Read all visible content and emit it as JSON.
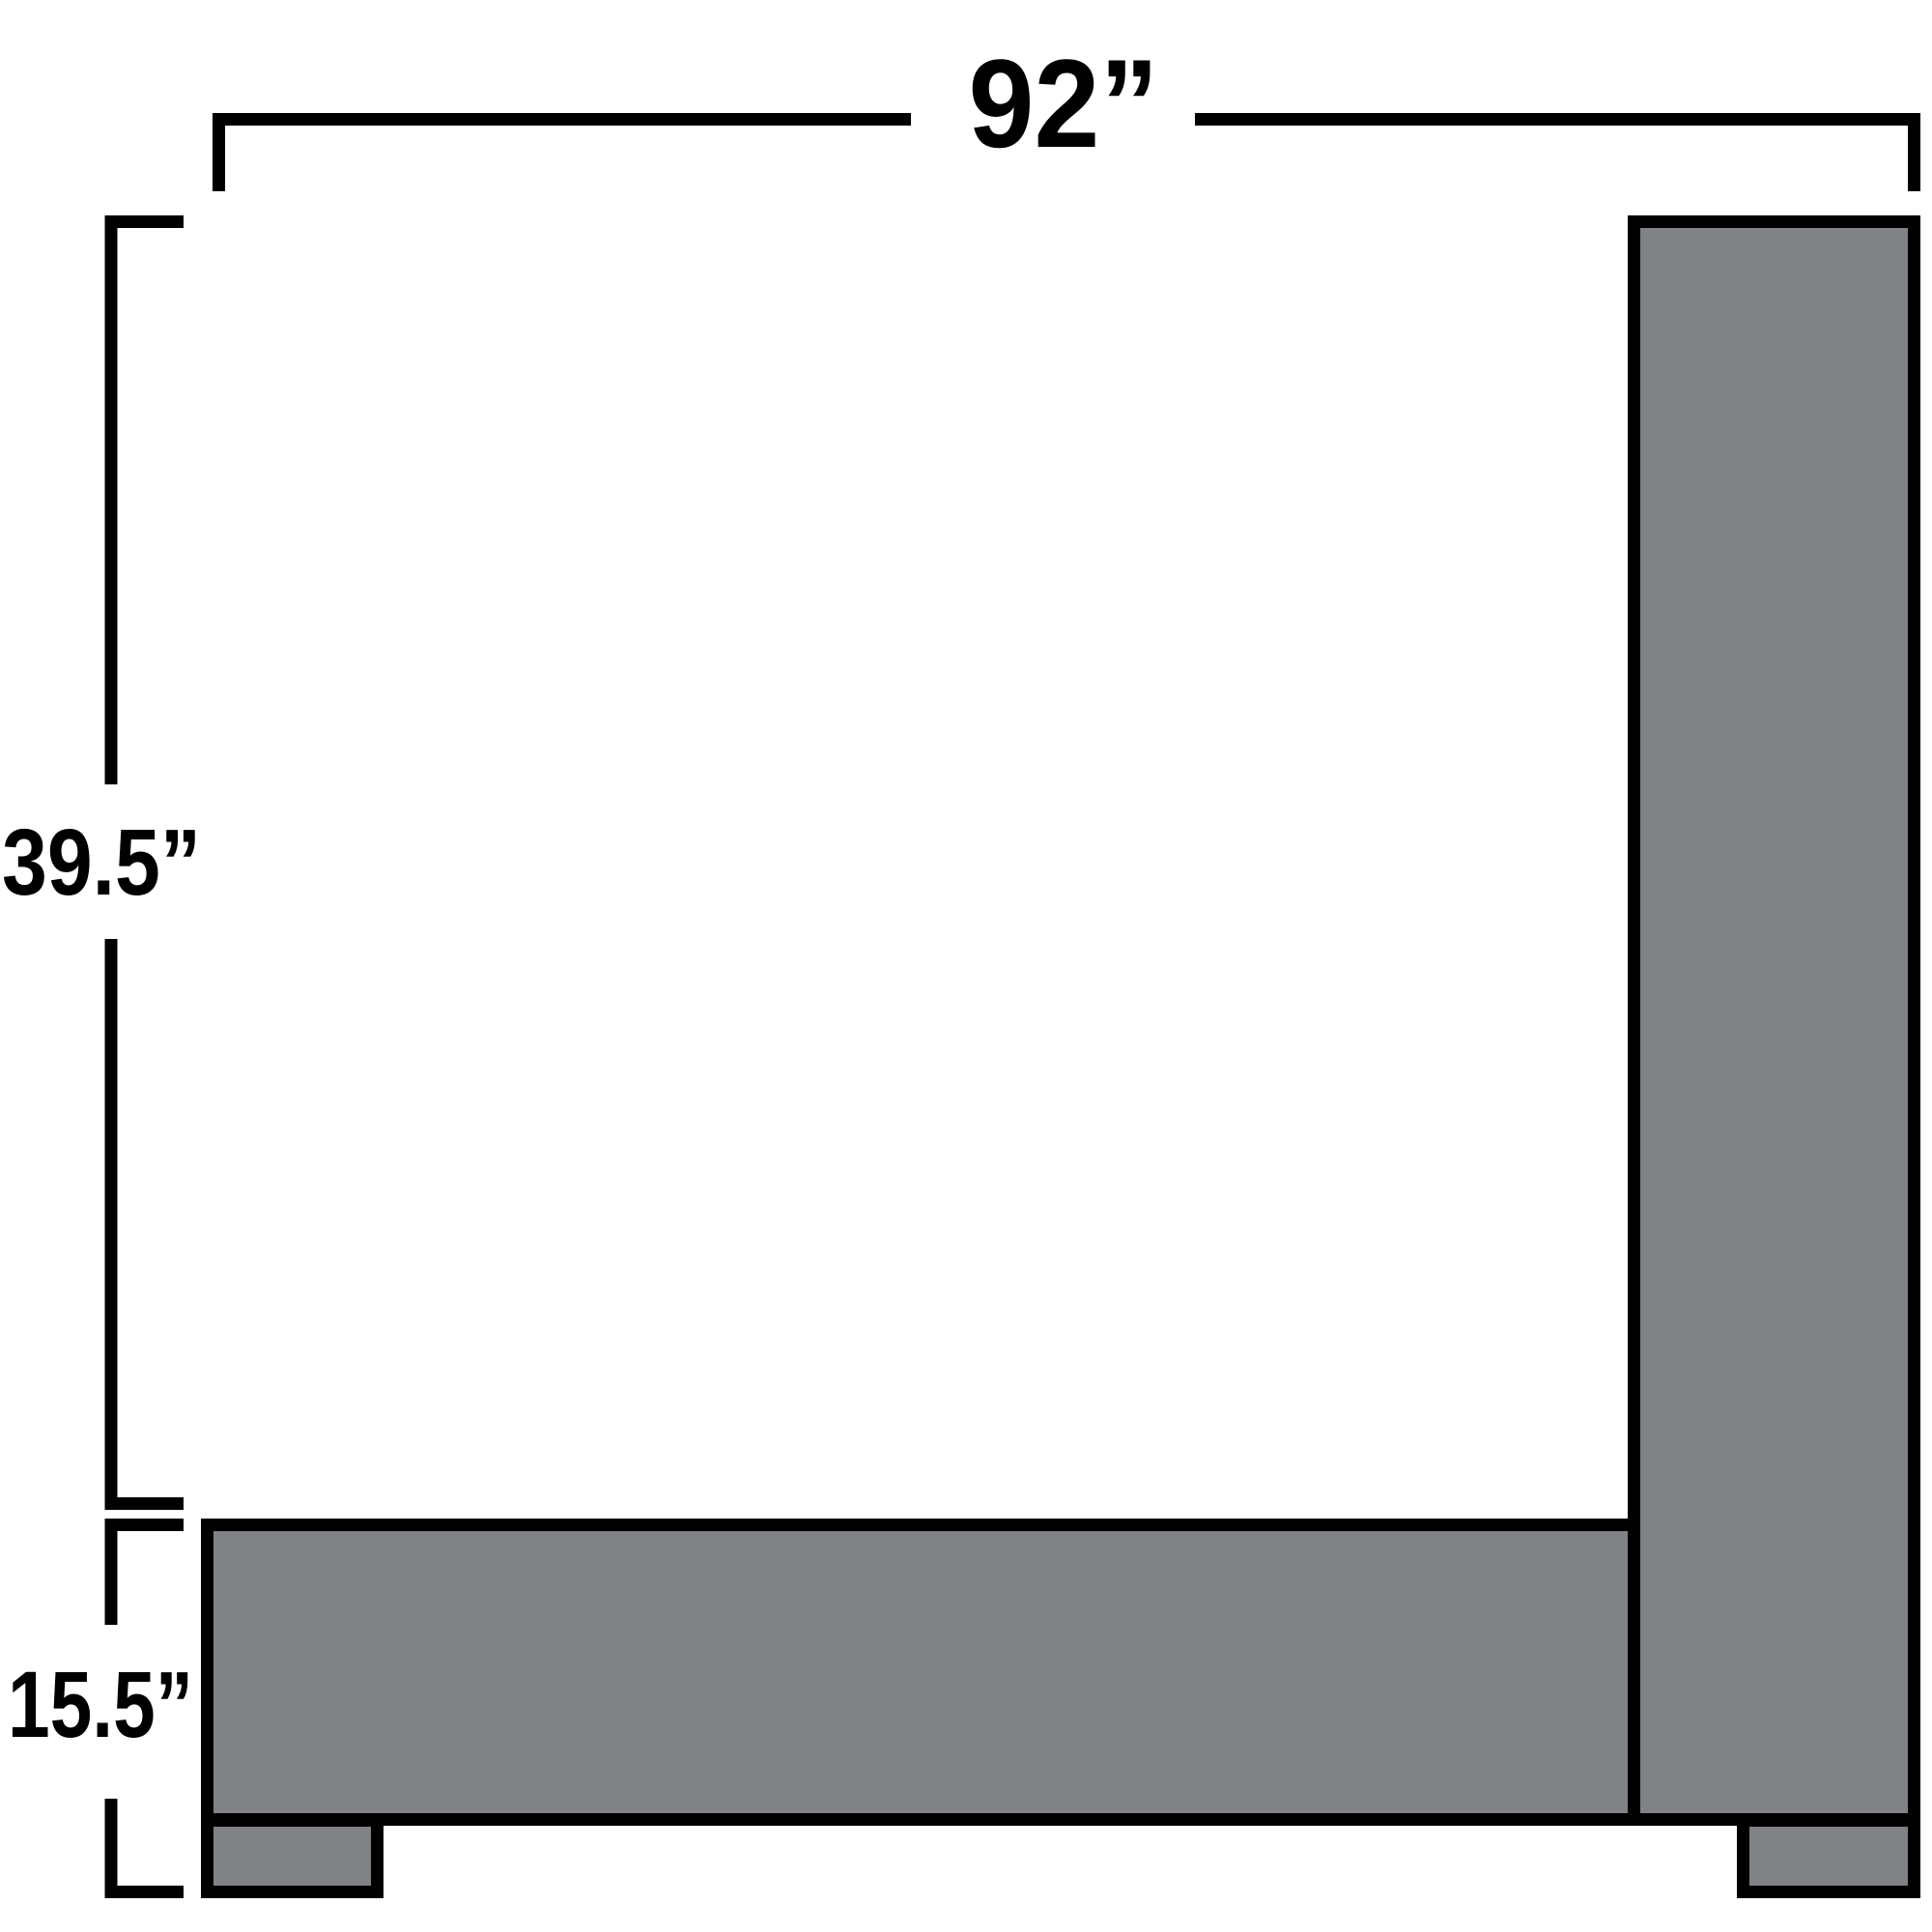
{
  "colors": {
    "line": "#000000",
    "text": "#000000",
    "shape_fill": "#808285",
    "background": "#ffffff"
  },
  "dimensions": {
    "width": {
      "label": "92”",
      "inches": 92
    },
    "upper_height": {
      "label": "39.5”",
      "inches": 39.5
    },
    "base_height": {
      "label": "15.5”",
      "inches": 15.5
    }
  }
}
